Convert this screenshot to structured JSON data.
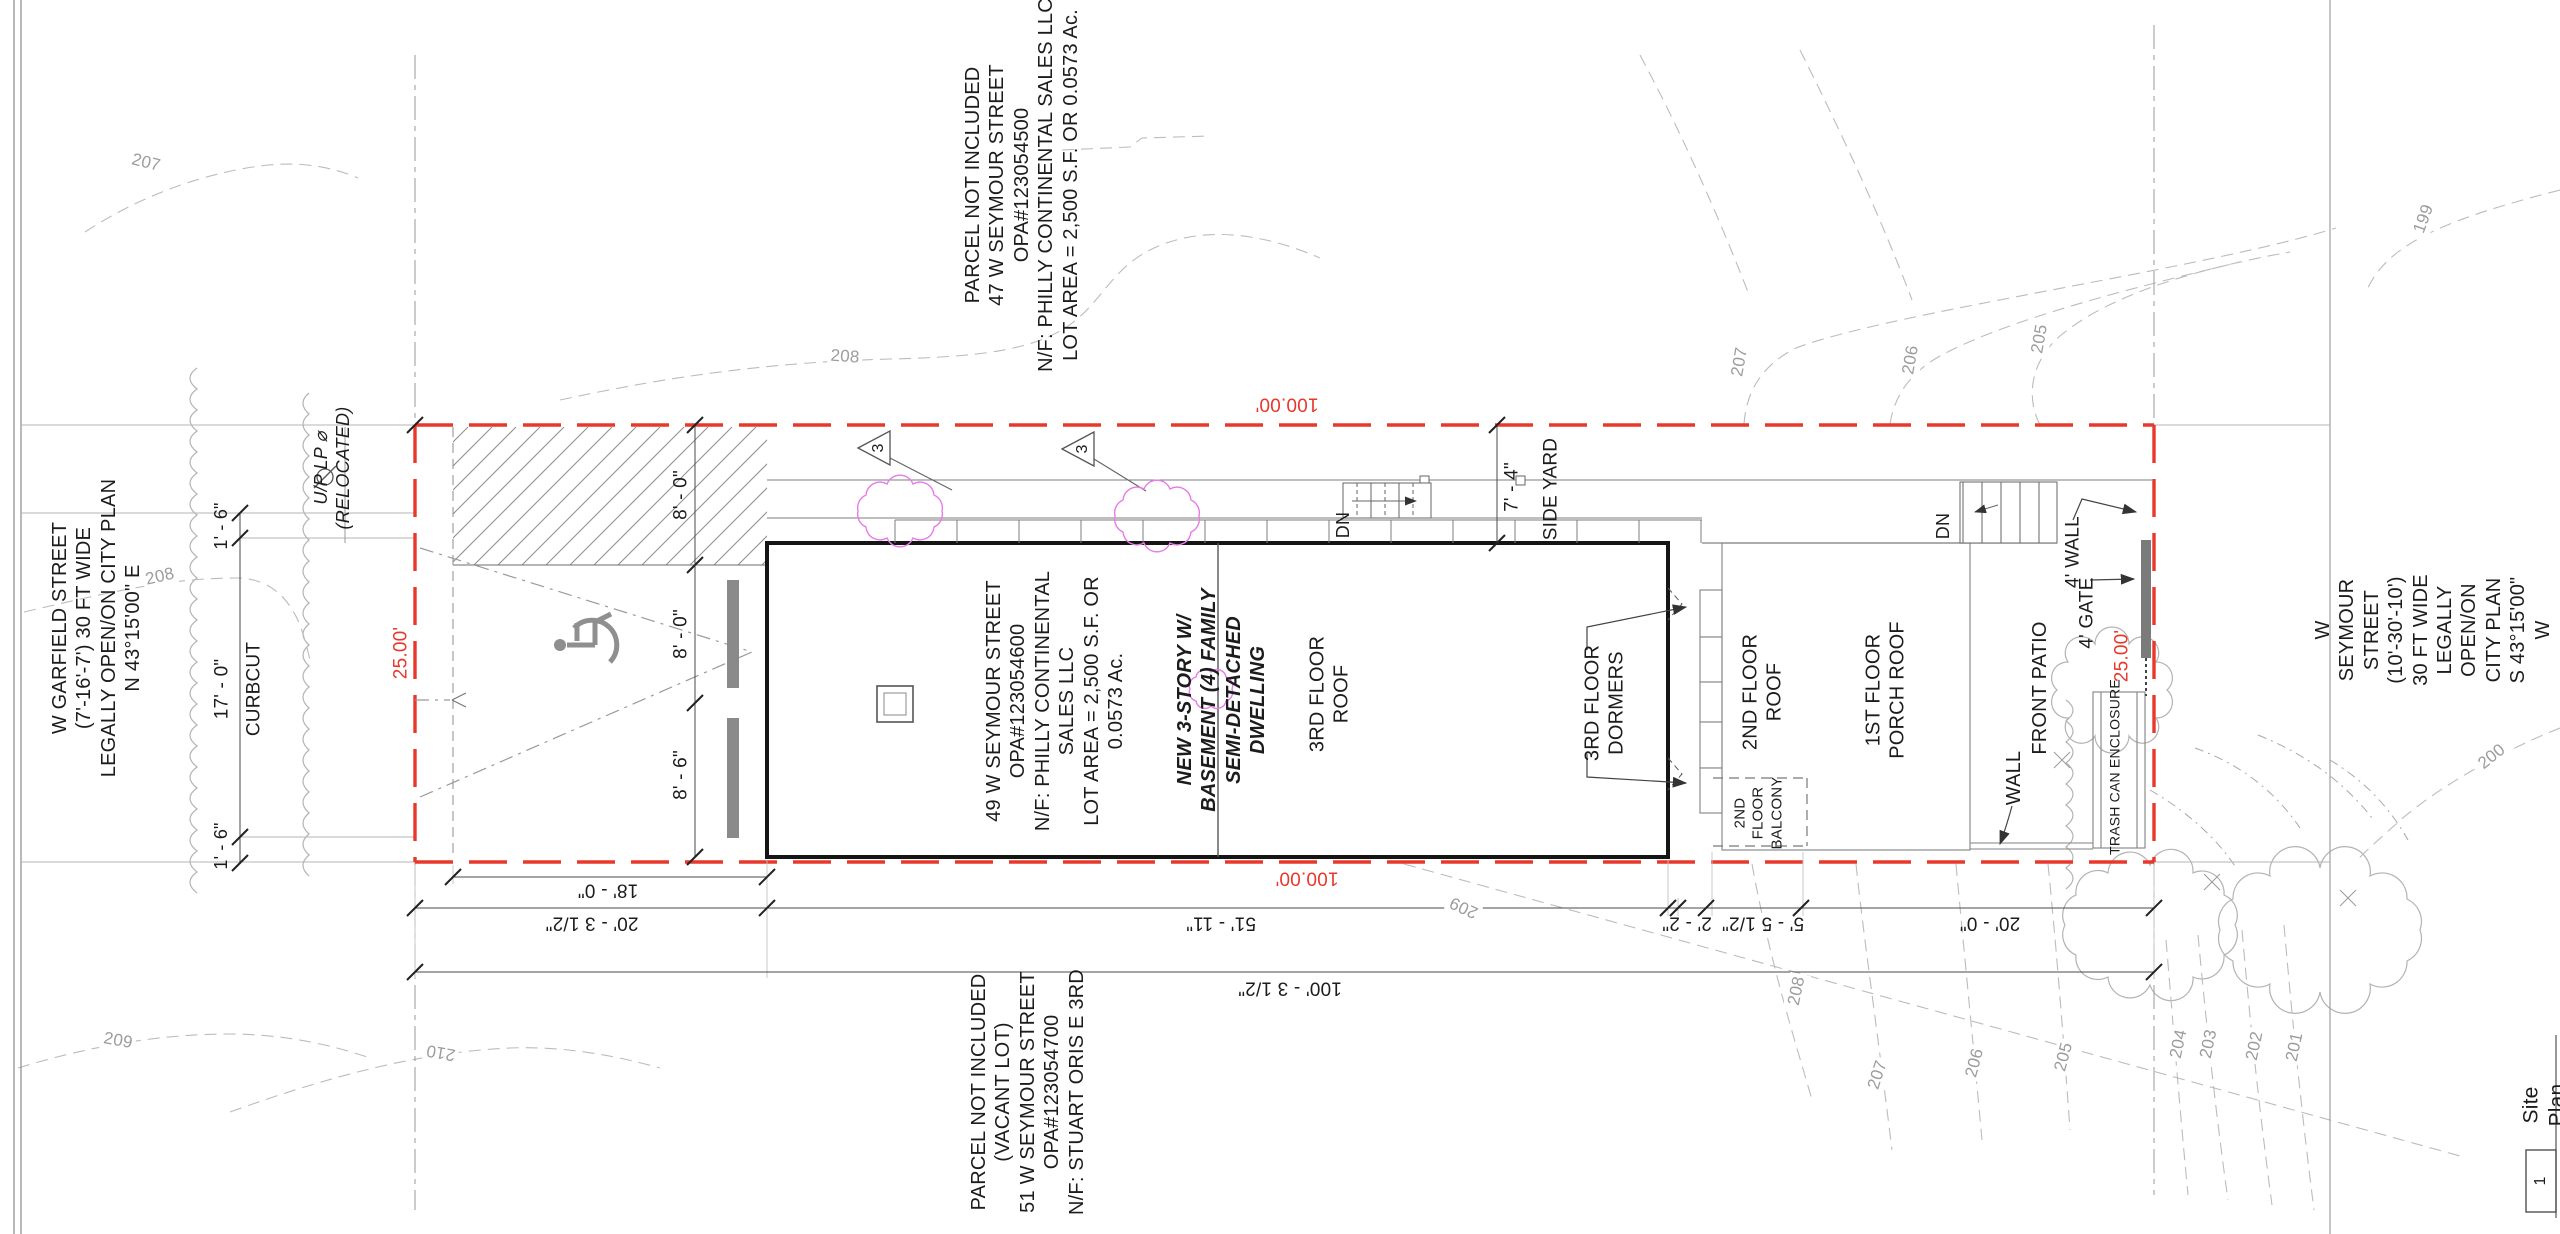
{
  "sheet": {
    "title": "Site Plan",
    "number": "1"
  },
  "streets": {
    "garfield": "W GARFIELD STREET\n(7'-16'-7') 30 FT WIDE\nLEGALLY OPEN/ON CITY PLAN\nN 43°15'00\" E",
    "seymour": "W SEYMOUR STREET\n(10'-30'-10') 30 FT WIDE\nLEGALLY OPEN/ON CITY PLAN\nS 43°15'00\" W"
  },
  "parcels": {
    "north": "PARCEL NOT INCLUDED\n47 W SEYMOUR STREET\nOPA#123054500\nN/F: PHILLY CONTINENTAL SALES LLC\nLOT AREA = 2,500 S.F. OR 0.0573 Ac.",
    "south": "PARCEL NOT INCLUDED\n(VACANT LOT)\n51 W SEYMOUR STREET\nOPA#123054700\nN/F: STUART ORIS E 3RD",
    "subject": "49 W SEYMOUR STREET\nOPA#123054600\nN/F: PHILLY CONTINENTAL\nSALES LLC\nLOT AREA = 2,500 S.F. OR\n0.0573 Ac."
  },
  "building": {
    "dwelling": "NEW 3-STORY W/\nBASEMENT (4) FAMILY\nSEMI-DETACHED\nDWELLING",
    "roof_3rd": "3RD FLOOR\nROOF",
    "dormers_3rd": "3RD FLOOR\nDORMERS",
    "roof_2nd": "2ND FLOOR\nROOF",
    "balcony_2nd": "2ND\nFLOOR\nBALCONY",
    "porch_1st": "1ST FLOOR\nPORCH ROOF"
  },
  "site": {
    "front_patio": "FRONT PATIO",
    "trash": "TRASH CAN ENCLOSURE",
    "wall": "WALL",
    "wall_4ft": "4' WALL",
    "gate_4ft": "4' GATE",
    "side_yard": "SIDE YARD",
    "curbcut": "CURBCUT",
    "up_lp": "U/P LP ⌀\n(RELOCATED)",
    "dn": "DN"
  },
  "dims": {
    "lot_width": "25.00'",
    "lot_length": "100.00'",
    "d18_0": "18' - 0\"",
    "d20_3h": "20' - 3 1/2\"",
    "d51_11": "51' - 11\"",
    "d2_2": "2' - 2\"",
    "d5_5h": "5' - 5 1/2\"",
    "d20_0": "20' - 0\"",
    "d100_3h": "100' - 3 1/2\"",
    "d8_0": "8' - 0\"",
    "d8_6": "8' - 6\"",
    "d1_6": "1' - 6\"",
    "d17_0": "17' - 0\"",
    "d7_4": "7' - 4\""
  },
  "notes": {
    "flag_3": "3"
  },
  "contours": {
    "c199": "199",
    "c200": "200",
    "c201": "201",
    "c202": "202",
    "c203": "203",
    "c204": "204",
    "c205": "205",
    "c206": "206",
    "c207": "207",
    "c208": "208",
    "c209": "209",
    "c210": "210"
  }
}
